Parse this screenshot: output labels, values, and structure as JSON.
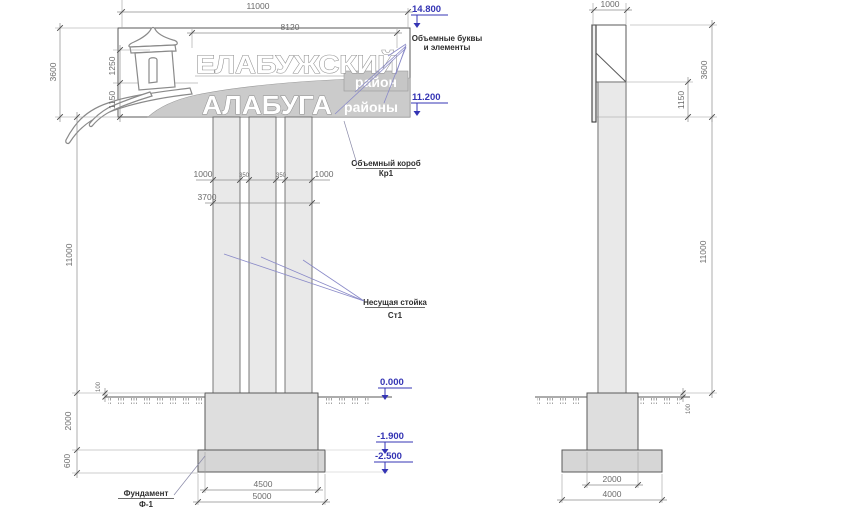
{
  "front": {
    "sign": {
      "title": "ЕЛАБУЖСКИЙ",
      "title_tag": "район",
      "subtitle": "АЛАБУГА",
      "subtitle_tag": "районы"
    },
    "dims": {
      "width_total": "11000",
      "letters_width": "8120",
      "sign_height": "3600",
      "tier_upper": "1250",
      "tier_lower": "1150",
      "col_left": "1000",
      "gap_left": "350",
      "gap_right": "350",
      "col_right": "1000",
      "cols_total": "3700",
      "post_height": "11000",
      "embed_depth": "2000",
      "slab_thickness": "600",
      "above_ground": "100",
      "pedestal_width": "4500",
      "slab_width": "5000"
    }
  },
  "side": {
    "dims": {
      "depth": "1000",
      "sign_height": "3600",
      "tier_lower": "1150",
      "post_height": "11000",
      "above_ground": "100",
      "pedestal_width": "2000",
      "slab_width": "4000"
    }
  },
  "elevations": {
    "sign_top": "14.800",
    "sign_bottom": "11.200",
    "ground": "0.000",
    "pedestal_bottom": "-1.900",
    "slab_bottom": "-2.500"
  },
  "annotations": {
    "letters_l1": "Объемные буквы",
    "letters_l2": "и элементы",
    "box_l1": "Объемный короб",
    "box_l2": "Кр1",
    "post_l1": "Несущая стойка",
    "post_l2": "Ст1",
    "foundation_l1": "Фундамент",
    "foundation_l2": "Ф-1"
  },
  "colors": {
    "annotation_blue": "#3434b4",
    "leader_blue": "#8a8ac8",
    "line": "#555555",
    "fill_column": "#e9e9e9",
    "fill_foundation": "#dedede",
    "sign_band": "#cbcbcb"
  }
}
